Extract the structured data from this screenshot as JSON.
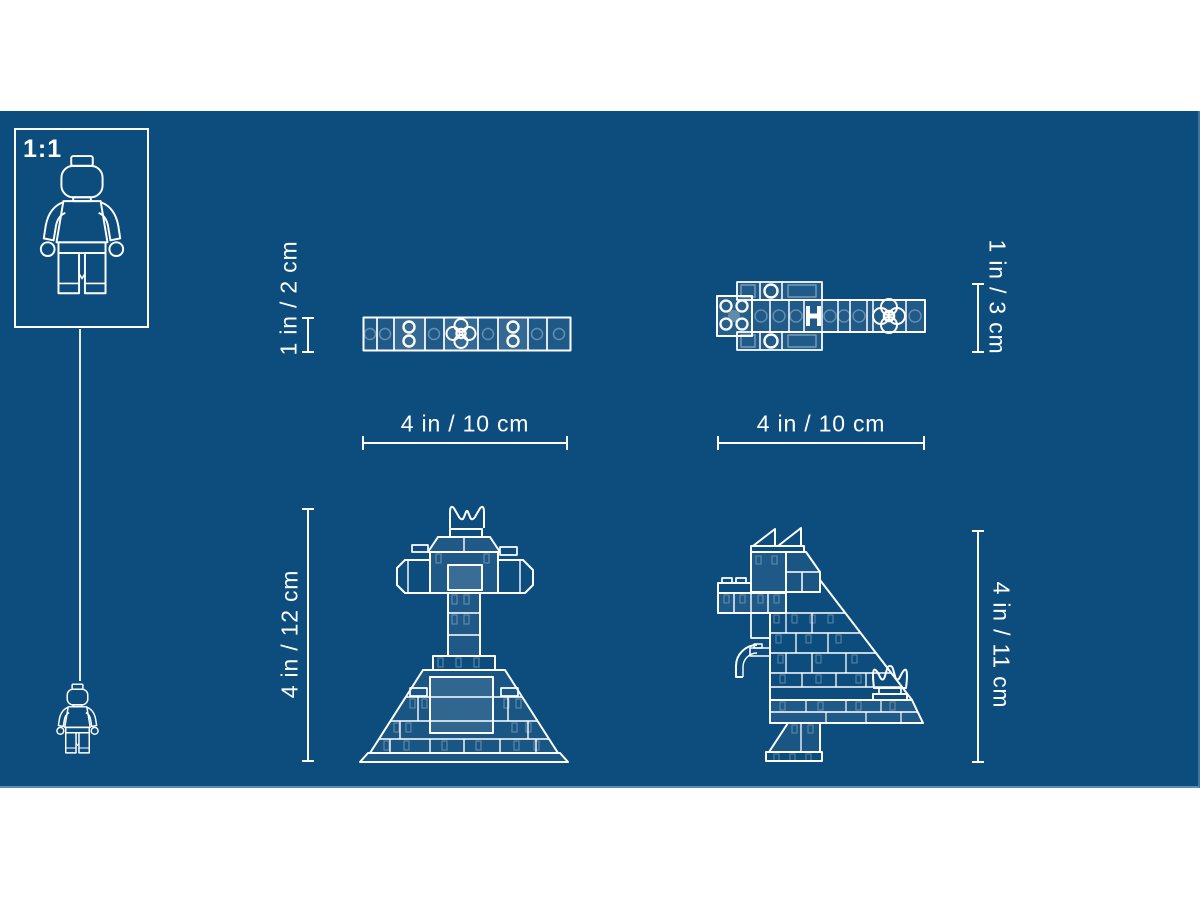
{
  "colors": {
    "page_bg": "#ffffff",
    "blueprint_bg": "#0d4d7e",
    "line": "#ffffff"
  },
  "scale_box": {
    "label": "1:1"
  },
  "figures": {
    "flat_plate": {
      "name": "flat plate build, top view",
      "height_label": "1 in / 2 cm",
      "width_label": "4 in / 10 cm"
    },
    "crocodile_top": {
      "name": "crocodile build, top view",
      "height_label": "1 in / 3 cm",
      "width_label": "4 in / 10 cm"
    },
    "windmill_front": {
      "name": "tower with crossbar and crown, front view",
      "height_label": "4 in / 12 cm"
    },
    "dinosaur_side": {
      "name": "dinosaur with flags and flower, side view",
      "height_label": "4 in / 11 cm"
    }
  }
}
